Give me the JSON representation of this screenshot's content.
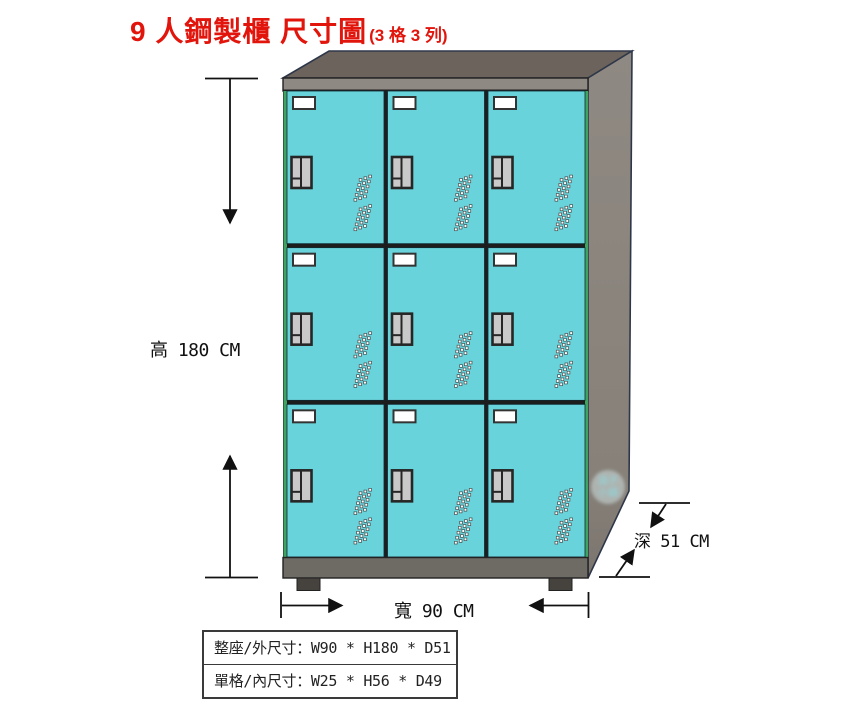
{
  "title": {
    "main": "9 人鋼製櫃 尺寸圖",
    "suffix": "(3 格 3 列)"
  },
  "dimensions": {
    "height": "高 180 CM",
    "width": "寬 90 CM",
    "depth": "深 51 CM"
  },
  "spec_table": {
    "rows": [
      "整座/外尺寸：W90 * H180 * D51",
      "單格/內尺寸：W25 * H56 * D49"
    ]
  },
  "locker": {
    "rows": 3,
    "cols": 3,
    "compartments": 9,
    "door_color": "#68d3da",
    "edge_green": "#3fa461",
    "frame_color": "#1d1d1d",
    "top_face_color": "#6b635c",
    "side_face_color": "#8d8781",
    "side_face_dark": "#7b756f",
    "front_strip_color": "#8f8983",
    "base_color": "#6e6a64",
    "foot_color": "#46433f",
    "handle_fill": "#c9c9c9",
    "handle_border": "#262626",
    "label_holder_fill": "#ffffff",
    "vent_fill": "#ffffff",
    "vent_border": "#4a4a4a",
    "outline_navy": "#2e3749",
    "line_color": "#111111"
  },
  "watermark": {
    "line1": "過子",
    "line2": "小舖"
  }
}
